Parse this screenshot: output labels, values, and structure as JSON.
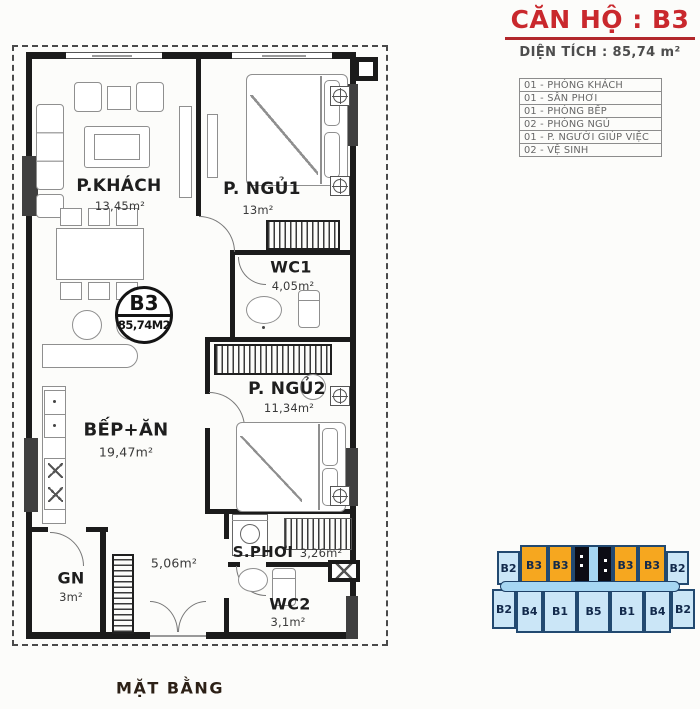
{
  "header": {
    "title": "CĂN HỘ : B3",
    "area_label": "DIỆN TÍCH : 85,74 m²"
  },
  "legend": {
    "items": [
      "01 - PHÒNG KHÁCH",
      "01 - SÂN PHƠI",
      "01 - PHÒNG BẾP",
      "02 - PHÒNG NGỦ",
      "01 - P. NGƯỜI GIÚP VIỆC",
      "02 - VỆ SINH"
    ]
  },
  "plan": {
    "caption": "MẶT BẰNG",
    "badge": {
      "code": "B3",
      "area": "85,74M2"
    },
    "rooms": [
      {
        "name": "P.KHÁCH",
        "area": "13,45m²"
      },
      {
        "name": "P. NGỦ1",
        "area": "13m²"
      },
      {
        "name": "WC1",
        "area": "4,05m²"
      },
      {
        "name": "P. NGỦ2",
        "area": "11,34m²"
      },
      {
        "name": "BẾP+ĂN",
        "area": "19,47m²"
      },
      {
        "name": "GN",
        "area": "3m²"
      },
      {
        "name": "S.PHƠI",
        "area": "3,26m²"
      },
      {
        "name": "WC2",
        "area": "3,1m²"
      }
    ],
    "hall_area": "5,06m²",
    "icons": {
      "door": "quarter-arc",
      "casement_window": "circle-cross-square",
      "fixed_window": "x-square",
      "washing_machine": "drum-circle",
      "wardrobe": "hatched-strip"
    }
  },
  "keyplan": {
    "top_row": [
      "B2",
      "B3",
      "B3",
      "B3",
      "B3",
      "B2"
    ],
    "bottom_row": [
      "B2",
      "B4",
      "B1",
      "B5",
      "B1",
      "B4",
      "B2"
    ],
    "highlight_label": "B3"
  },
  "colors": {
    "accent_red": "#C9282D",
    "wall_black": "#1B1B1B",
    "keyplan_orange": "#F6A71F",
    "keyplan_blue": "#CBE6F7",
    "keyplan_outline": "#1E4066",
    "legend_text": "#666666"
  }
}
